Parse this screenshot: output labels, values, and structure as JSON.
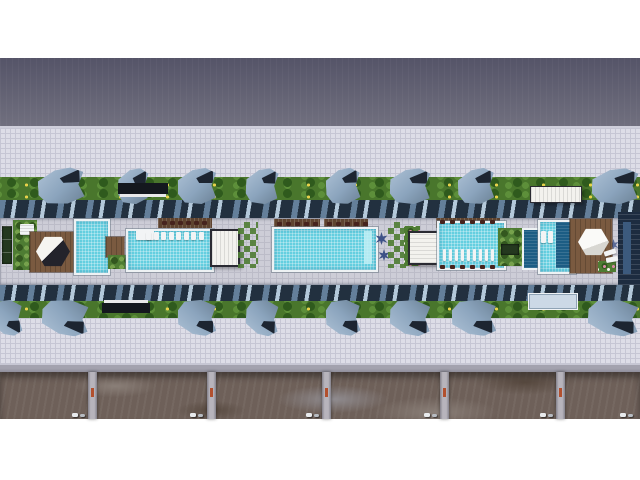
{
  "scene": {
    "description": "Aerial top-down 3D architectural rendering of a long residential complex amenity deck with five swimming pools, hexagonal cabanas on wood decks, lounge chairs, pergolas, landscaped planters, rows of angular blue canopy structures over hedges, tiled plazas on both sides, and unfinished ground lots with parked cars along the bottom",
    "region_names": [
      "top-margin",
      "shadow-roof-band",
      "upper-plaza",
      "upper-hedge-row",
      "upper-glass-roofline",
      "amenity-pool-deck",
      "lower-glass-roofline",
      "lower-hedge-row",
      "lower-plaza",
      "curb-strip",
      "ground-lots",
      "bottom-margin"
    ],
    "counts": {
      "pools": 5,
      "hex_cabanas": 3,
      "canopies_top": 8,
      "canopies_bottom": 8,
      "ground_lots": 6,
      "car_pairs": 6
    },
    "canopies_top": [
      {
        "x": 38,
        "w": 46,
        "r": -3
      },
      {
        "x": 118,
        "w": 30,
        "r": 2
      },
      {
        "x": 178,
        "w": 38,
        "r": 0
      },
      {
        "x": 246,
        "w": 32,
        "r": 3
      },
      {
        "x": 326,
        "w": 34,
        "r": -2
      },
      {
        "x": 390,
        "w": 40,
        "r": 2
      },
      {
        "x": 458,
        "w": 36,
        "r": -1
      },
      {
        "x": 592,
        "w": 46,
        "r": 2
      }
    ],
    "canopies_bottom": [
      {
        "x": -8,
        "w": 30,
        "r": 2
      },
      {
        "x": 42,
        "w": 46,
        "r": -2
      },
      {
        "x": 178,
        "w": 38,
        "r": 1
      },
      {
        "x": 246,
        "w": 32,
        "r": -2
      },
      {
        "x": 326,
        "w": 34,
        "r": 2
      },
      {
        "x": 390,
        "w": 40,
        "r": -1
      },
      {
        "x": 452,
        "w": 44,
        "r": 1
      },
      {
        "x": 588,
        "w": 50,
        "r": -2
      }
    ],
    "chair_rows": [
      {
        "x": 162,
        "y": 221,
        "n": 6,
        "step": 8
      },
      {
        "x": 277,
        "y": 222,
        "n": 5,
        "step": 9
      },
      {
        "x": 327,
        "y": 222,
        "n": 5,
        "step": 9
      },
      {
        "x": 440,
        "y": 220,
        "n": 6,
        "step": 10
      },
      {
        "x": 440,
        "y": 265,
        "n": 6,
        "step": 10
      }
    ],
    "lap_pool_loungers": [
      146,
      154,
      161,
      169,
      176,
      184,
      191,
      199
    ],
    "pool4_loungers": [
      443,
      449,
      455,
      461,
      467,
      473,
      479,
      485,
      491
    ],
    "lot_dividers": [
      88,
      207,
      322,
      440,
      556
    ],
    "car_pairs": [
      72,
      190,
      306,
      424,
      540,
      620
    ]
  },
  "palette": {
    "white": "#ffffff",
    "dark_band_top": "#555468",
    "dark_band_bottom": "#71707f",
    "plaza": "#dddde7",
    "plaza_line": "#c6c6d4",
    "curb": "#9b9aa6",
    "hedge": "#49762c",
    "hedge_dark": "#2f5a1d",
    "flower": "#e8d24a",
    "canopy": "#8ba4bd",
    "canopy_shadow": "#1d2531",
    "roof_navy": "#22303f",
    "roof_steel": "#647f9a",
    "roof_glass": "#b4c9da",
    "deck": "#cdcdd7",
    "deck_line": "#bcbcc8",
    "water": "#64cfe0",
    "water_deep": "#1c5d84",
    "pool_rim": "#eef2f4",
    "wood": "#7a5a40",
    "wood_dark": "#5e432f",
    "pavilion_white": "#f3f2ee",
    "frame_dark": "#2a2a32",
    "plant": "#4e7c33",
    "plant_dark": "#33571f",
    "flower_pink": "#d98aa6",
    "palm": "#3f5288",
    "chair": "#46231d",
    "ground": "#6e6059",
    "ground_light": "#8a7f78",
    "ground_dark": "#57493f",
    "ground_blue": "#908c90",
    "divider": "#b7b4bc",
    "divider_mark": "#b2502e",
    "building_navy": "#1d2c40",
    "car_white": "#e8eaec"
  }
}
